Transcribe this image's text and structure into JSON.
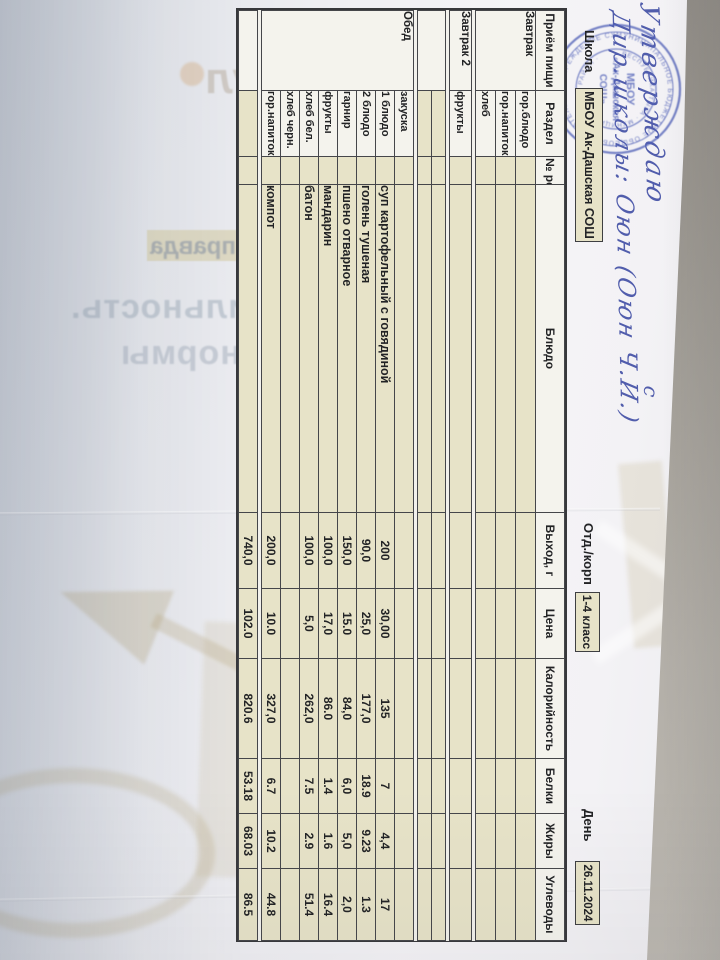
{
  "info": {
    "school_label": "Школа",
    "school_value": "МБОУ Ак-Дашская СОШ",
    "dept_label": "Отд./корп",
    "dept_value": "1-4 класс",
    "day_label": "День",
    "day_value": "26.11.2024"
  },
  "menu": {
    "headers": [
      "Приём пищи",
      "Раздел",
      "№ рец.",
      "Блюдо",
      "Выход, г",
      "Цена",
      "Калорийность",
      "Белки",
      "Жиры",
      "Углеводы"
    ],
    "breakfast": {
      "meal": "Завтрак",
      "rows": [
        {
          "part": "гор.блюдо"
        },
        {
          "part": "гор.напиток"
        },
        {
          "part": "хлеб"
        }
      ]
    },
    "breakfast2": {
      "meal": "Завтрак 2",
      "rows": [
        {
          "part": "фрукты"
        }
      ]
    },
    "lunch": {
      "meal": "Обед",
      "rows": [
        {
          "part": "закуска",
          "dish": "",
          "out": "",
          "price": "",
          "kcal": "",
          "protein": "",
          "fat": "",
          "carbs": ""
        },
        {
          "part": "1 блюдо",
          "dish": "суп картофельный с говядиной",
          "out": "200",
          "price": "30,00",
          "kcal": "135",
          "protein": "7",
          "fat": "4,4",
          "carbs": "17"
        },
        {
          "part": "2 блюдо",
          "dish": "голень тушеная",
          "out": "90,0",
          "price": "25,0",
          "kcal": "177,0",
          "protein": "18.9",
          "fat": "9.23",
          "carbs": "1.3"
        },
        {
          "part": "гарнир",
          "dish": "пшено отварное",
          "out": "150,0",
          "price": "15.0",
          "kcal": "84,0",
          "protein": "6,0",
          "fat": "5,0",
          "carbs": "2,0"
        },
        {
          "part": "фрукты",
          "dish": "мандарин",
          "out": "100,0",
          "price": "17,0",
          "kcal": "86.0",
          "protein": "1.4",
          "fat": "1.6",
          "carbs": "16.4"
        },
        {
          "part": "хлеб бел.",
          "dish": "батон",
          "out": "100,0",
          "price": "5,0",
          "kcal": "262,0",
          "protein": "7.5",
          "fat": "2.9",
          "carbs": "51.4"
        },
        {
          "part": "хлеб черн.",
          "dish": "",
          "out": "",
          "price": "",
          "kcal": "",
          "protein": "",
          "fat": "",
          "carbs": ""
        },
        {
          "part": "гор.напиток",
          "dish": "компот",
          "out": "200,0",
          "price": "10.0",
          "kcal": "327,0",
          "protein": "6.7",
          "fat": "10.2",
          "carbs": "44.8"
        }
      ]
    },
    "total": {
      "out": "740,0",
      "price": "102.0",
      "kcal": "820.6",
      "protein": "53.18",
      "fat": "68.03",
      "carbs": "86.5"
    }
  },
  "signature": {
    "line1": "Утверждаю",
    "line2": "Дир.школы: Оюн (Оюн Ч.И.)",
    "mark": "с"
  },
  "stamp": {
    "outer_ring": "МУНИЦИПАЛЬНОЕ БЮДЖЕТНОЕ ОБЩЕОБРАЗОВАТЕЛЬНОЕ УЧРЕЖДЕНИЕ СУТ · 1700714 1718 ·",
    "inner_ring": "· РЕСПУБЛИКА ТЫВА · МУНИЦИПАЛЬНЫЙ РАЙОН ·",
    "center1": "МБОУ",
    "center2": "«Ак-Дашская",
    "center3": "СОШ»"
  },
  "watermark": {
    "logo_text": "Умскул",
    "highlight_word": "правда",
    "line1": "Социальная мобильность.",
    "line2": "Контроль и нормы"
  },
  "colors": {
    "paper": "#f2f1ec",
    "cell_beige": "#e7e3c8",
    "grid_line": "#45464a",
    "stamp_blue": "#5262b8",
    "ink_blue": "#3a48a2",
    "desk_gray": "#a5a19a"
  }
}
